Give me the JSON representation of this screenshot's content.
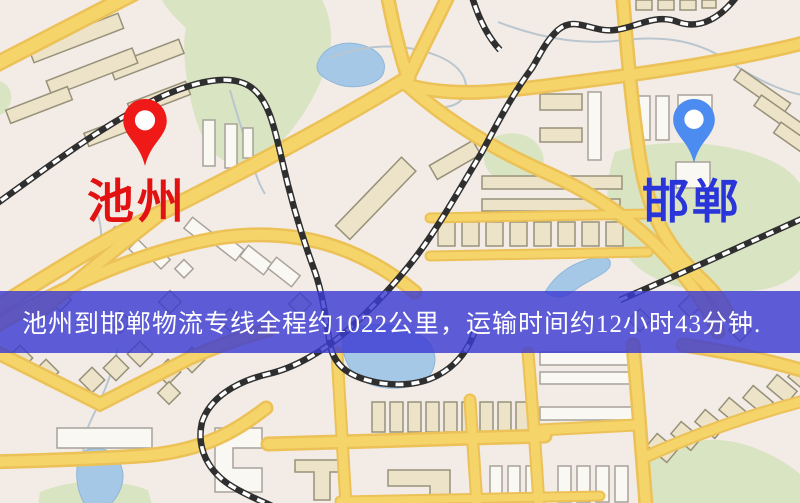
{
  "banner": {
    "text": "池州到邯郸物流专线全程约1022公里，运输时间约12小时43分钟."
  },
  "route": {
    "origin": "池州",
    "destination": "邯郸",
    "distance_km": "1022",
    "duration": "12小时43分钟"
  },
  "markers": {
    "origin": {
      "label": "池州",
      "pin_icon": "red-map-pin"
    },
    "destination": {
      "label": "邯郸",
      "pin_icon": "blue-map-pin"
    }
  },
  "theme": {
    "map_bg": "#f3ece6",
    "road": "#f5d469",
    "road_casing": "#ecc157",
    "building": "#ece3c8",
    "building_outline": "#97917a",
    "water": "#a5c8e6",
    "park": "#d8e4c2",
    "railway": "#2f2f2f",
    "origin_pin": "#ef1a17",
    "destination_pin": "#4c8bf0",
    "origin_label": "#e31212",
    "destination_label": "#2a35d9",
    "banner_bg": "rgba(60,60,210,0.82)",
    "banner_text": "#ffffff"
  }
}
